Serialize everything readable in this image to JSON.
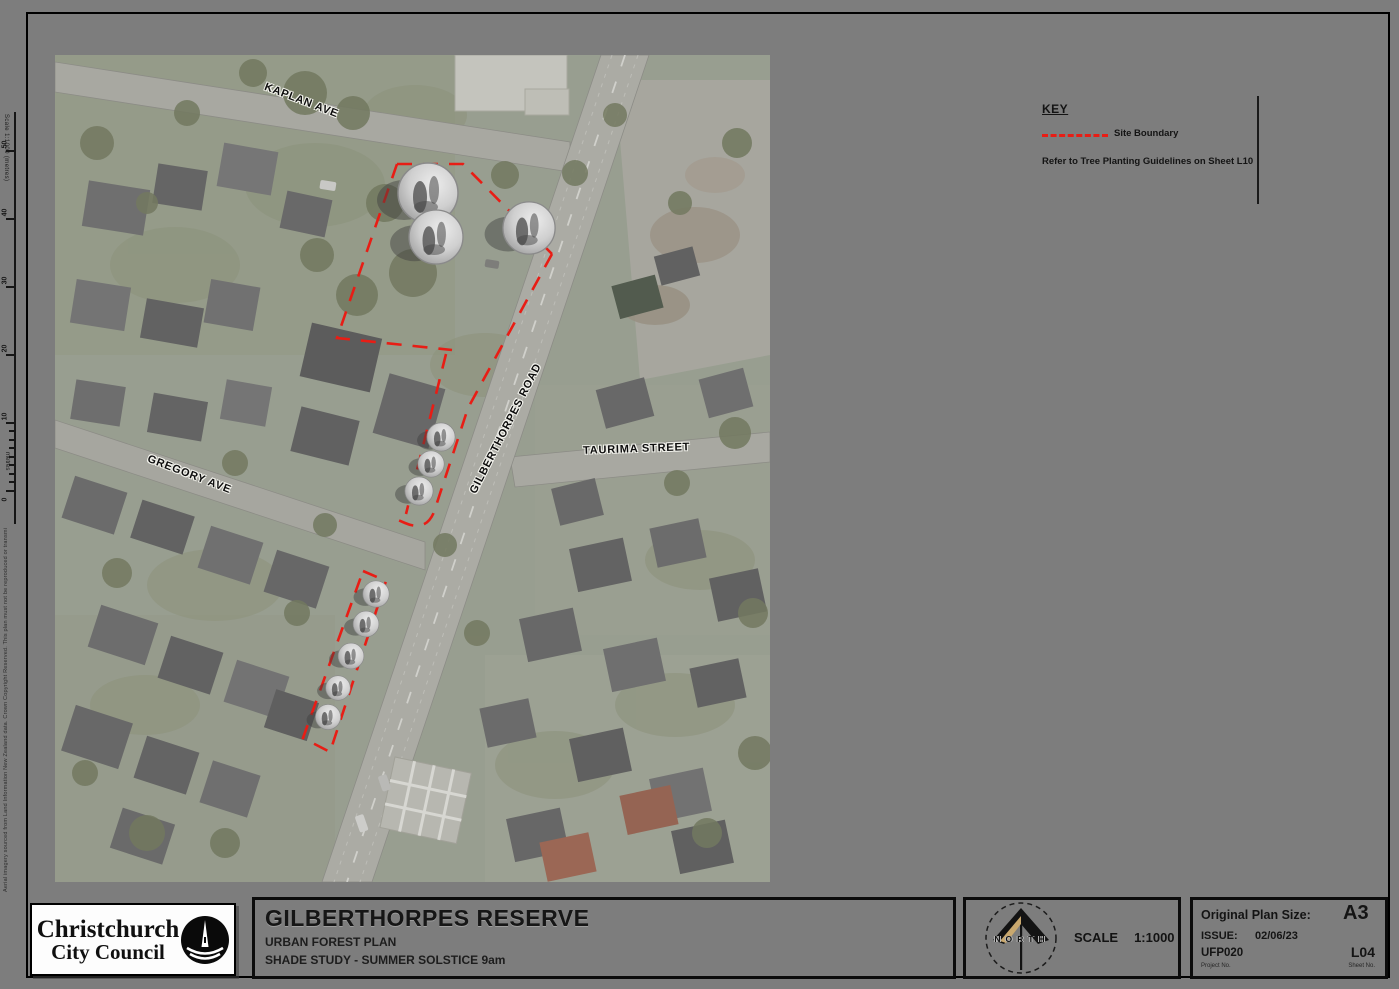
{
  "key": {
    "title": "KEY",
    "site_boundary_label": "Site Boundary",
    "note": "Refer to Tree Planting Guidelines on Sheet L10"
  },
  "map": {
    "streets": {
      "kaplan": "KAPLAN AVE",
      "gilberthorpes": "GILBERTHORPES ROAD",
      "taurima": "TAURIMA STREET",
      "gregory": "GREGORY AVE"
    },
    "site_boundary_color": "#e81d15"
  },
  "scalebar": {
    "caption": "Scale 1:1000 (metres)",
    "labels": [
      "50",
      "40",
      "30",
      "20",
      "10",
      "0"
    ],
    "unit": "metres"
  },
  "edge_note": "Aerial imagery sourced from Land Information New Zealand data. Crown Copyright Reserved. This plan must not be reproduced or transmitted without the permission of Christchurch City Council.",
  "logo": {
    "line1": "Christchurch",
    "line2": "City Council"
  },
  "title_block": {
    "title": "GILBERTHORPES RESERVE",
    "subtitle": "URBAN FOREST PLAN",
    "sheet_name": "SHADE STUDY - SUMMER SOLSTICE 9am"
  },
  "north_scale": {
    "north_label": "NORTH",
    "scale_label": "SCALE",
    "scale_value": "1:1000"
  },
  "info": {
    "plan_size_label": "Original Plan Size:",
    "plan_size_value": "A3",
    "issue_label": "ISSUE:",
    "issue_date": "02/06/23",
    "project_no": "UFP020",
    "project_no_label": "Project No.",
    "sheet_no": "L04",
    "sheet_no_label": "Sheet No."
  }
}
